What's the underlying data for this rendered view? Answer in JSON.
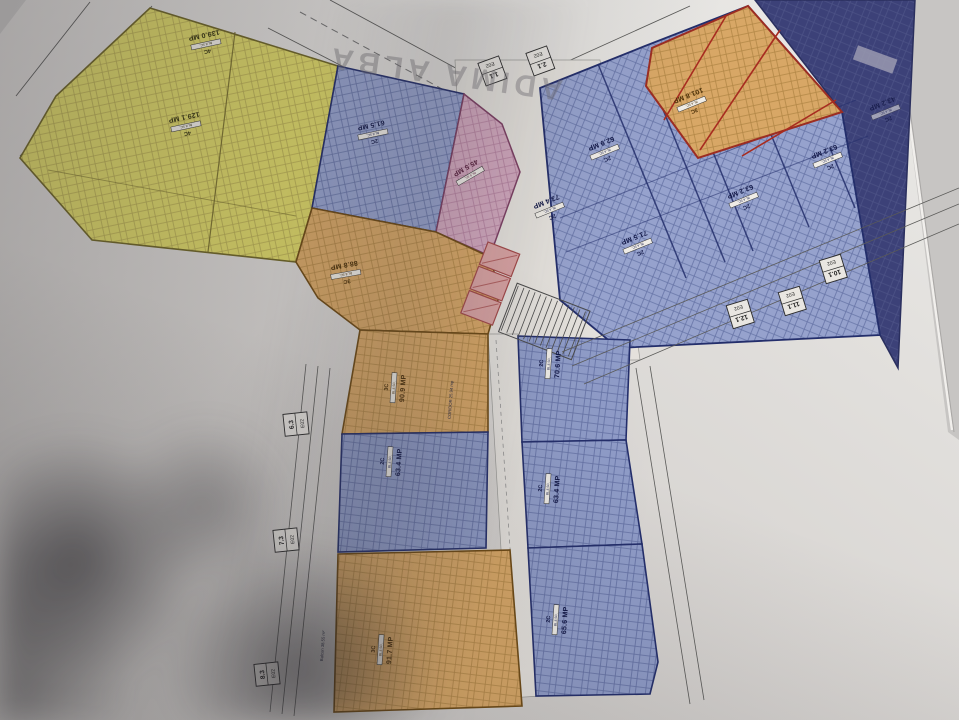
{
  "scene": {
    "watermark": "ADIMA ALBA"
  },
  "labels": {
    "corridor": "CORIDOR 25.94 mp",
    "balcony": "Balcon 38.55 m²"
  },
  "axis_markers": [
    {
      "num": "6.3",
      "code": "E02"
    },
    {
      "num": "7.3",
      "code": "E02"
    },
    {
      "num": "8.3",
      "code": "E02"
    },
    {
      "num": "10.1",
      "code": "E02"
    },
    {
      "num": "11.1",
      "code": "E02"
    },
    {
      "num": "12.1",
      "code": "E02"
    },
    {
      "num": "1.1",
      "code": "E02"
    },
    {
      "num": "2.1",
      "code": "E02"
    }
  ],
  "units": {
    "y139": {
      "type": "4C",
      "block": "BL.6 SC.",
      "area": "139.0 MP"
    },
    "y129": {
      "type": "4C",
      "block": "BL.6 SC.",
      "area": "129.1 MP"
    },
    "b615": {
      "type": "2C",
      "block": "BL.6 SC.",
      "area": "61.5 MP"
    },
    "p455": {
      "block": "BL.6 SC.",
      "area": "45.5 MP"
    },
    "o888": {
      "type": "3C",
      "block": "BL.6 SC.",
      "area": "88.8 MP"
    },
    "o1018": {
      "type": "3C",
      "block": "BL.6 SC.",
      "area": "101.8 MP"
    },
    "b629": {
      "type": "2C",
      "block": "BL.6 SC.",
      "area": "62.9 MP"
    },
    "b734": {
      "type": "2C",
      "block": "BL.6 SC.",
      "area": "73.4 MP"
    },
    "b715": {
      "type": "2C",
      "block": "BL.6 SC.",
      "area": "71.5 MP"
    },
    "b632a": {
      "type": "2C",
      "block": "BL.6 SC.",
      "area": "63.2 MP"
    },
    "b632b": {
      "type": "2C",
      "block": "BL.6 SC.",
      "area": "63.2 MP"
    },
    "n432": {
      "type": "2C",
      "block": "BL.6 SC.",
      "area": "43.2 MP"
    },
    "o909": {
      "type": "3C",
      "block": "BL.6 SC.",
      "area": "90.9 MP"
    },
    "b634a": {
      "type": "2C",
      "block": "BL.6 SC.",
      "area": "63.4 MP"
    },
    "o917": {
      "type": "3C",
      "block": "BL.6 SC.",
      "area": "91.7 MP"
    },
    "b706": {
      "type": "2C",
      "block": "BL.6 SC.",
      "area": "70.6 MP"
    },
    "b634b": {
      "type": "2C",
      "block": "BL.6 SC.",
      "area": "63.4 MP"
    },
    "b656": {
      "type": "2C",
      "block": "BL.6 SC.",
      "area": "65.6 MP"
    }
  },
  "colors": {
    "paper": "#d8d5d2",
    "yellow_unit": "#dbd567",
    "blue_unit": "#96a2cd",
    "navy_block": "#3c4178",
    "orange_unit": "#d8a766",
    "pink_unit": "#d2a8be",
    "stair_red": "#d8a2a2",
    "crossed_out_red": "#a82c20"
  }
}
